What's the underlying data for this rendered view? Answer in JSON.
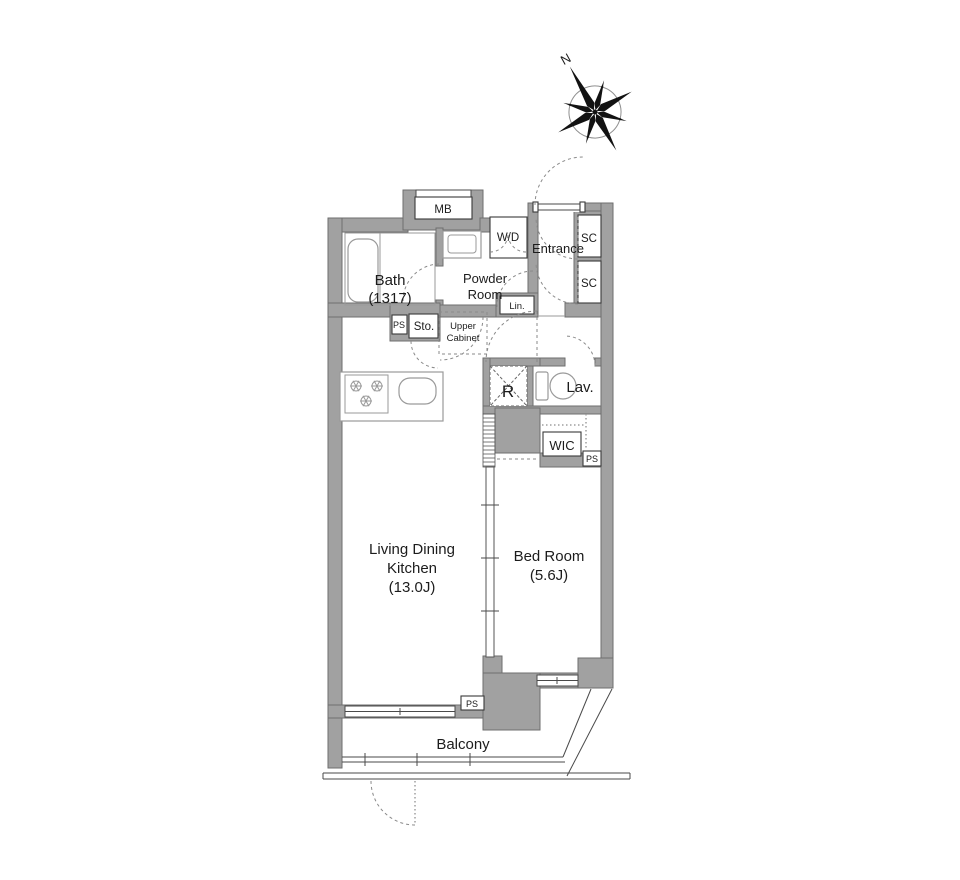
{
  "labels": {
    "compass_north": "N",
    "meter_box": "MB",
    "bath": "Bath",
    "bath_size": "(1317)",
    "washer_dryer": "W/D",
    "powder_line1": "Powder",
    "powder_line2": "Room",
    "entrance": "Entrance",
    "shoe_closet_top": "SC",
    "shoe_closet_bottom": "SC",
    "linen": "Lin.",
    "pipe_space_kitchen": "PS",
    "storage": "Sto.",
    "upper_cabinet_line1": "Upper",
    "upper_cabinet_line2": "Cabinet",
    "refrigerator": "R",
    "lavatory": "Lav.",
    "wic": "WIC",
    "pipe_space_bedroom": "PS",
    "ldk_line1": "Living Dining",
    "ldk_line2": "Kitchen",
    "ldk_size": "(13.0J)",
    "bedroom": "Bed Room",
    "bedroom_size": "(5.6J)",
    "pipe_space_balcony": "PS",
    "balcony": "Balcony"
  },
  "colors": {
    "wall_fill": "#a1a1a1",
    "wall_outline": "#6e6e6e",
    "line": "#4a4a4a",
    "text": "#1c1c1c",
    "dashed_door": "#8a8a8a"
  }
}
